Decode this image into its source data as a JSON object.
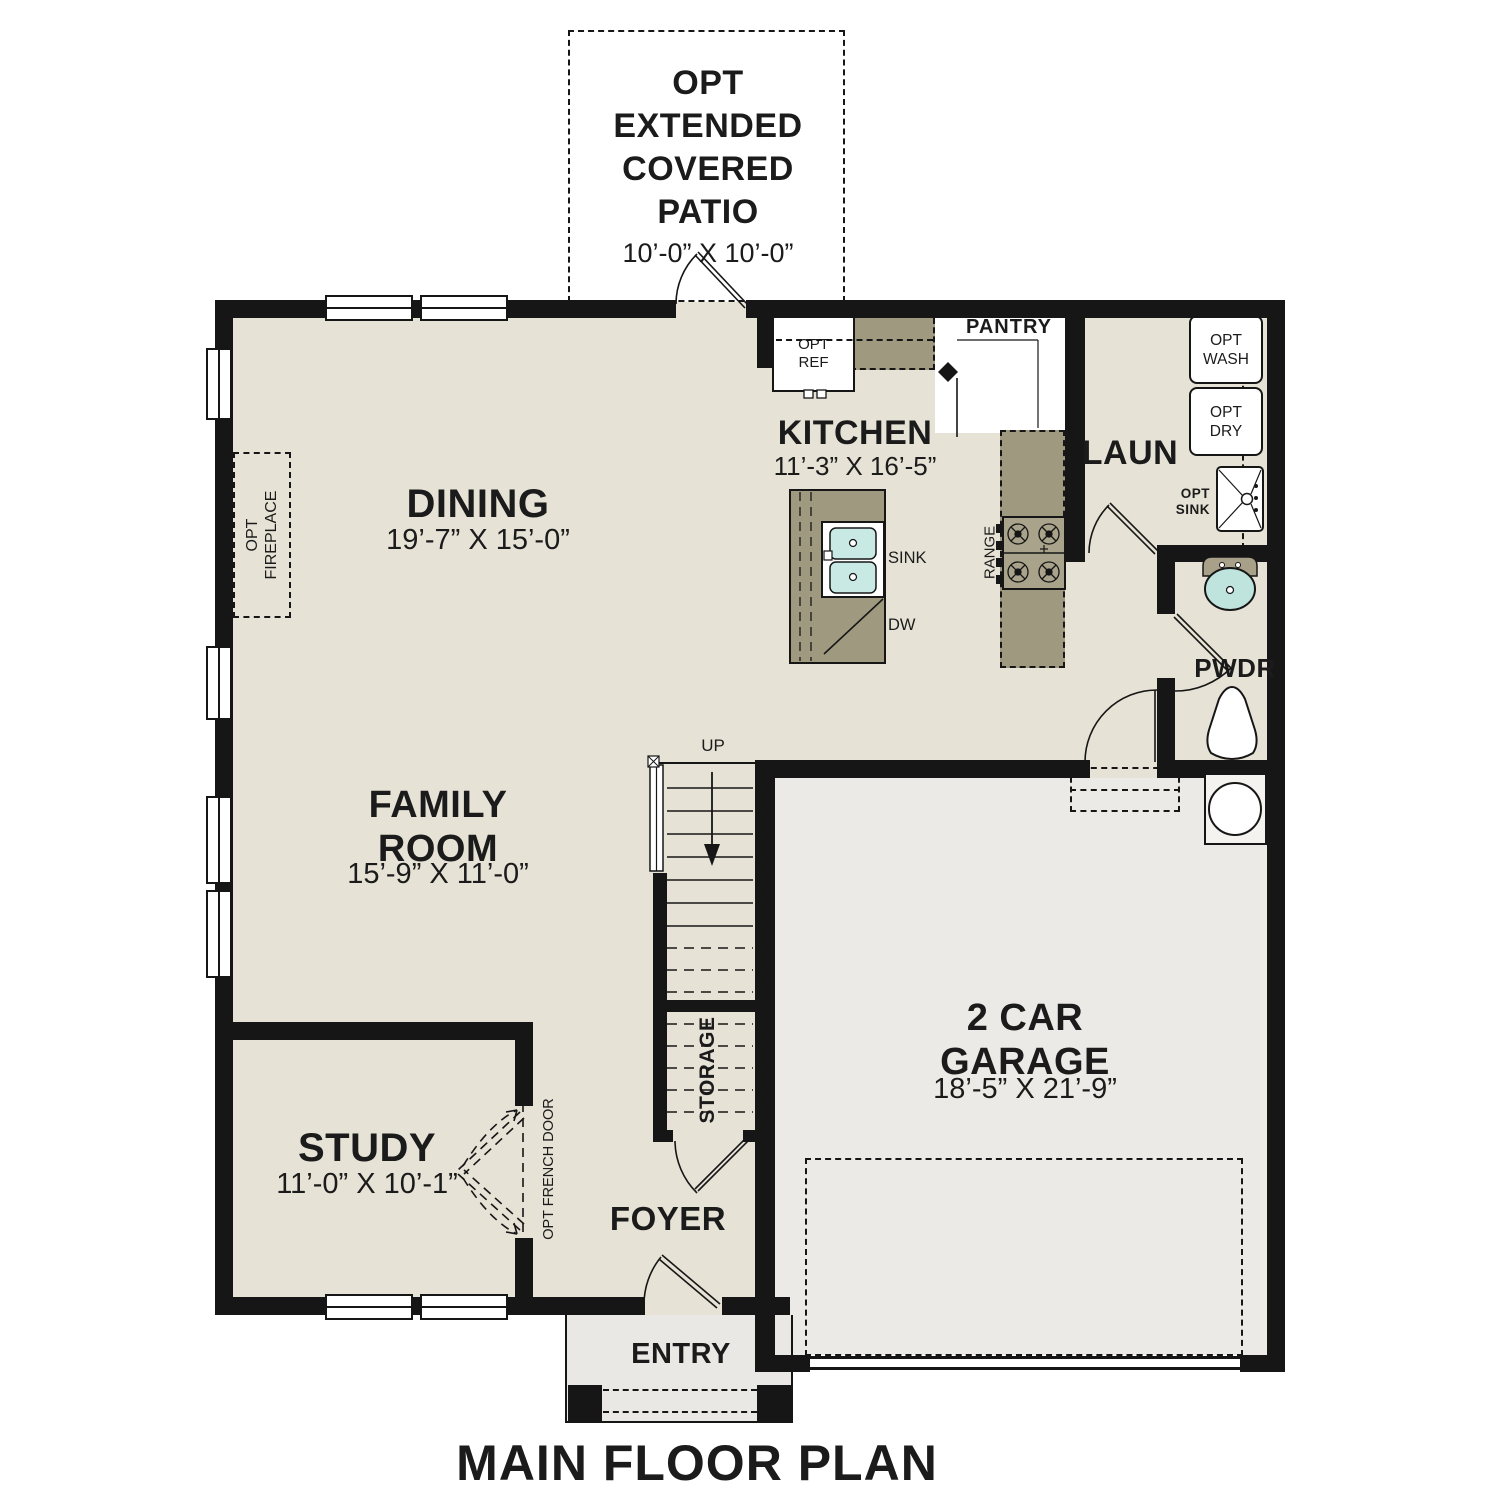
{
  "title": "MAIN FLOOR PLAN",
  "colors": {
    "floor": "#e6e2d5",
    "garage_floor": "#eceae6",
    "porch_floor": "#eae8e4",
    "counter": "#9e997f",
    "walls": "#161616",
    "sink_basin": "#c9e9e5"
  },
  "rooms": {
    "patio": {
      "label": "OPT\nEXTENDED\nCOVERED\nPATIO",
      "dims": "10’-0” X 10’-0”"
    },
    "dining": {
      "label": "DINING",
      "dims": "19’-7” X 15’-0”"
    },
    "kitchen": {
      "label": "KITCHEN",
      "dims": "11’-3” X 16’-5”"
    },
    "pantry": {
      "label": "PANTRY"
    },
    "laundry": {
      "label": "LAUN"
    },
    "powder": {
      "label": "PWDR"
    },
    "family_room": {
      "label": "FAMILY\nROOM",
      "dims": "15’-9” X 11’-0”"
    },
    "study": {
      "label": "STUDY",
      "dims": "11’-0” X 10’-1”"
    },
    "foyer": {
      "label": "FOYER"
    },
    "entry": {
      "label": "ENTRY"
    },
    "garage": {
      "label": "2 CAR\nGARAGE",
      "dims": "18’-5” X 21’-9”"
    },
    "storage": {
      "label": "STORAGE"
    }
  },
  "annotations": {
    "up": "UP",
    "sink": "SINK",
    "dw": "DW",
    "range": "RANGE",
    "opt_ref": "OPT\nREF",
    "opt_wash": "OPT\nWASH",
    "opt_dry": "OPT\nDRY",
    "opt_sink": "OPT\nSINK",
    "opt_fireplace": "OPT\nFIREPLACE",
    "opt_french_door": "OPT FRENCH DOOR"
  }
}
